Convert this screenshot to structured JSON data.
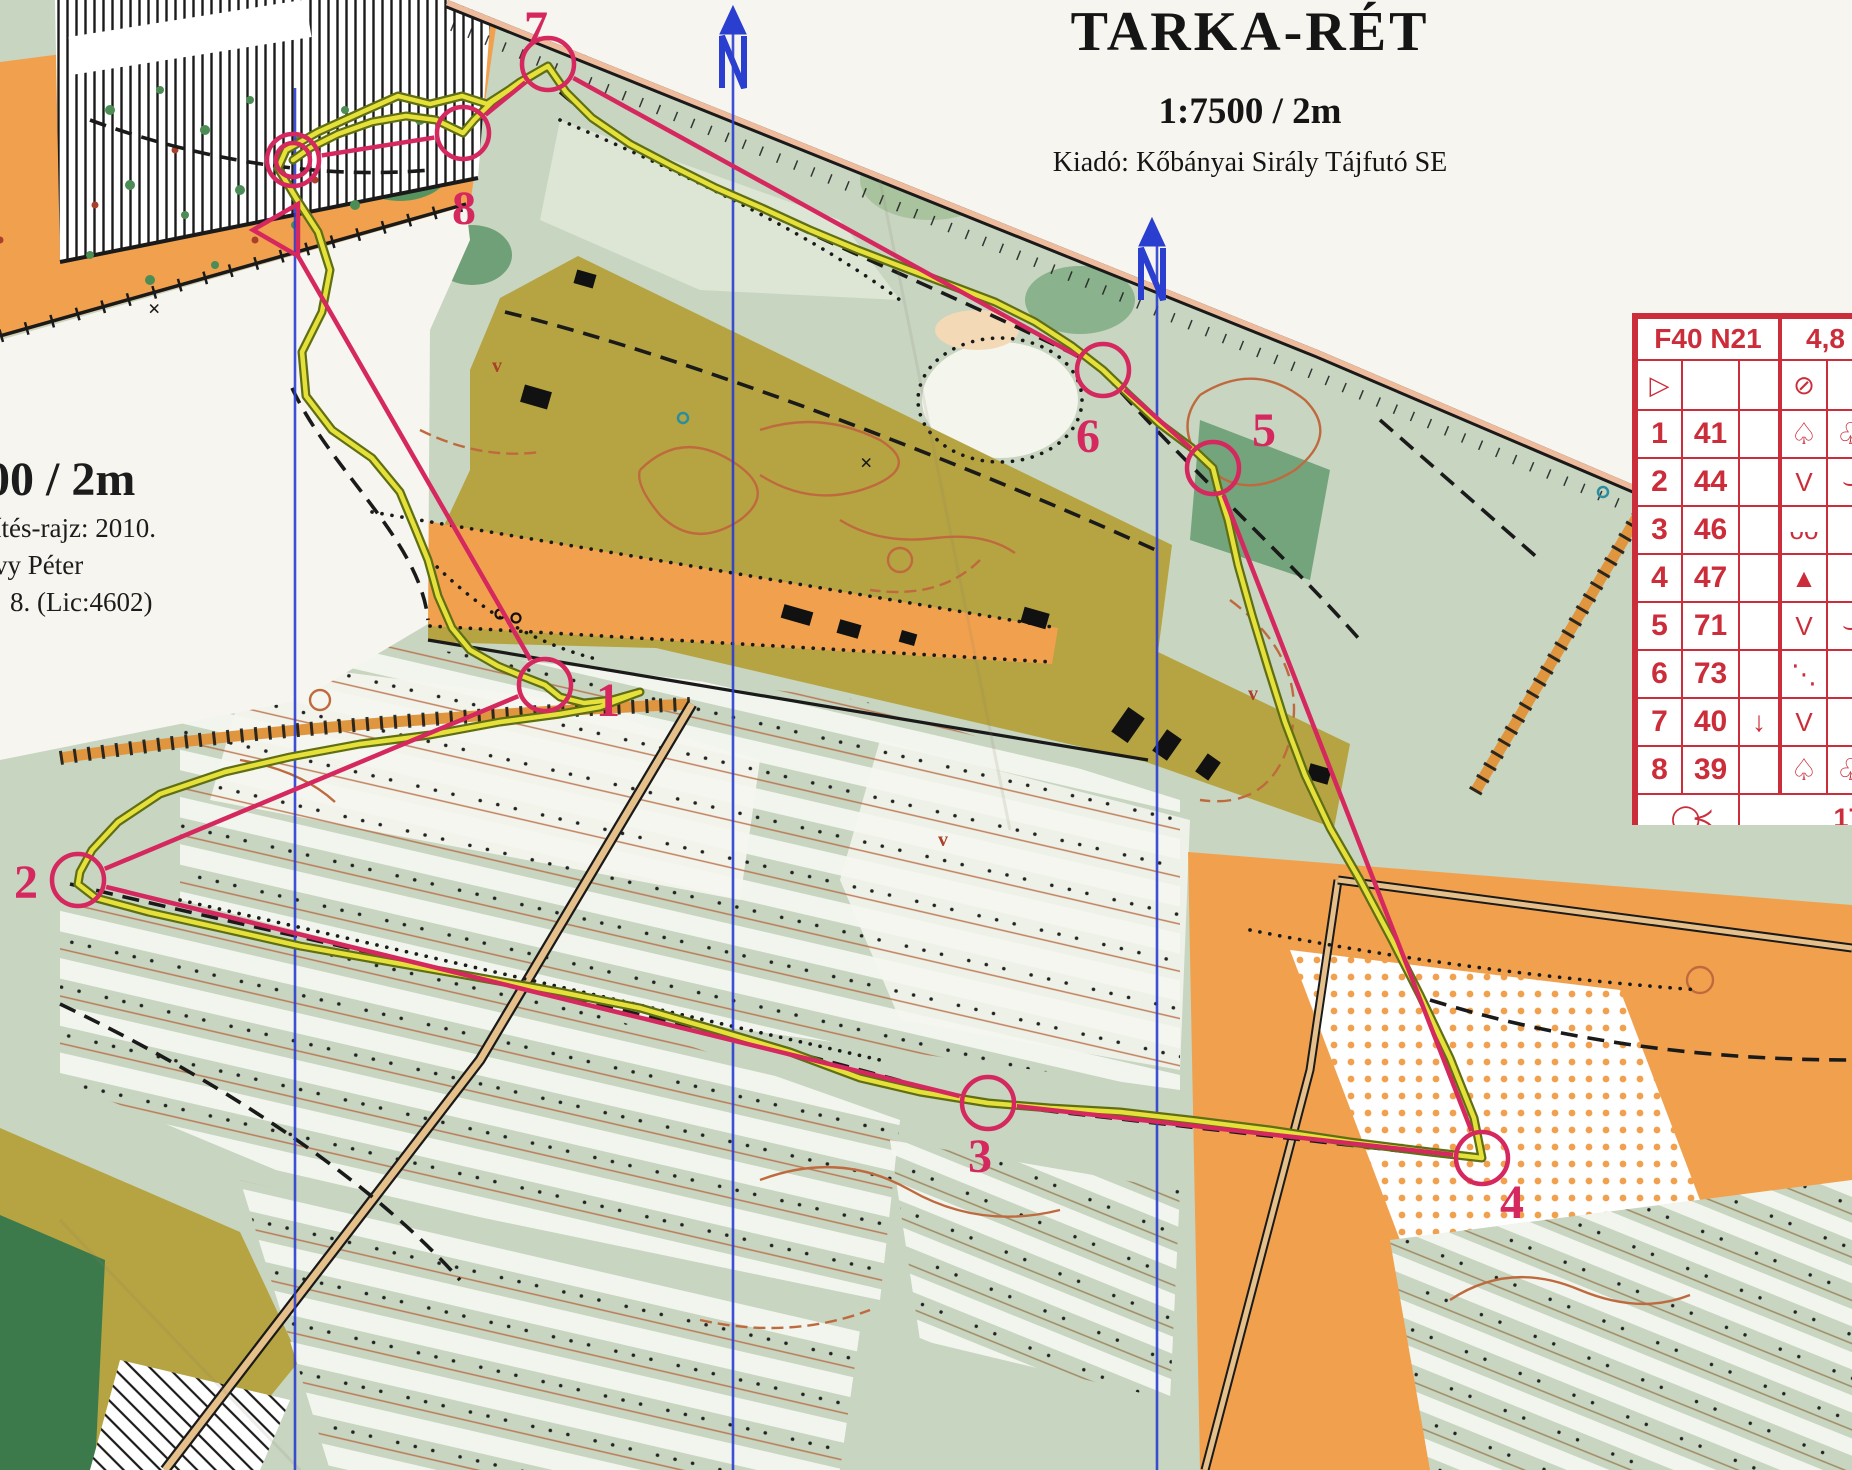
{
  "title_block": {
    "title": "TARKA-RÉT",
    "scale": "1:7500 / 2m",
    "publisher": "Kiadó: Kőbányai Sirály Tájfutó SE"
  },
  "margin_notes": {
    "scale_fragment": "00 / 2m",
    "line1": "ítés-rajz: 2010.",
    "line2": "vy Péter",
    "line3": "8. (Lic:4602)"
  },
  "control_card": {
    "class_label": "F40 N21",
    "course_length": "4,8",
    "finish_distance": "170 m",
    "start_symbol": "▷",
    "start_feature_symbol": "⊘",
    "finish_symbol": "◯≺",
    "rows": [
      {
        "num": "1",
        "code": "41",
        "c": "",
        "d": "♤",
        "e": "♧"
      },
      {
        "num": "2",
        "code": "44",
        "c": "",
        "d": "V",
        "e": "⌣"
      },
      {
        "num": "3",
        "code": "46",
        "c": "",
        "d": "ᴗᴗ",
        "e": ""
      },
      {
        "num": "4",
        "code": "47",
        "c": "",
        "d": "▲",
        "e": ""
      },
      {
        "num": "5",
        "code": "71",
        "c": "",
        "d": "V",
        "e": "⌣"
      },
      {
        "num": "6",
        "code": "73",
        "c": "",
        "d": "⋱",
        "e": ""
      },
      {
        "num": "7",
        "code": "40",
        "c": "↓",
        "d": "V",
        "e": ""
      },
      {
        "num": "8",
        "code": "39",
        "c": "",
        "d": "♤",
        "e": "♧"
      }
    ]
  },
  "course": {
    "color": "#d4285f",
    "controls": [
      {
        "id": "S",
        "x": 283,
        "y": 230
      },
      {
        "id": "1",
        "x": 545,
        "y": 685,
        "lx": 596,
        "ly": 716
      },
      {
        "id": "2",
        "x": 78,
        "y": 880,
        "lx": 14,
        "ly": 898
      },
      {
        "id": "3",
        "x": 988,
        "y": 1103,
        "lx": 968,
        "ly": 1172
      },
      {
        "id": "4",
        "x": 1482,
        "y": 1158,
        "lx": 1500,
        "ly": 1218
      },
      {
        "id": "5",
        "x": 1213,
        "y": 468,
        "lx": 1252,
        "ly": 446
      },
      {
        "id": "6",
        "x": 1103,
        "y": 370,
        "lx": 1076,
        "ly": 452
      },
      {
        "id": "7",
        "x": 548,
        "y": 64,
        "lx": 524,
        "ly": 44
      },
      {
        "id": "8",
        "x": 463,
        "y": 133,
        "lx": 452,
        "ly": 224
      },
      {
        "id": "F",
        "x": 293,
        "y": 160
      }
    ]
  },
  "gps_track": {
    "color_core": "#e6e13a",
    "color_edge": "#606e14",
    "points": [
      [
        548,
        66
      ],
      [
        518,
        84
      ],
      [
        487,
        104
      ],
      [
        462,
        96
      ],
      [
        430,
        104
      ],
      [
        398,
        96
      ],
      [
        362,
        112
      ],
      [
        318,
        132
      ],
      [
        286,
        150
      ],
      [
        278,
        168
      ],
      [
        296,
        198
      ],
      [
        318,
        232
      ],
      [
        330,
        270
      ],
      [
        322,
        312
      ],
      [
        302,
        352
      ],
      [
        306,
        396
      ],
      [
        332,
        430
      ],
      [
        372,
        458
      ],
      [
        400,
        492
      ],
      [
        415,
        528
      ],
      [
        428,
        560
      ],
      [
        438,
        596
      ],
      [
        452,
        628
      ],
      [
        470,
        650
      ],
      [
        498,
        666
      ],
      [
        522,
        676
      ],
      [
        545,
        685
      ],
      [
        560,
        697
      ],
      [
        584,
        703
      ],
      [
        612,
        700
      ],
      [
        640,
        692
      ],
      [
        600,
        707
      ],
      [
        560,
        714
      ],
      [
        500,
        722
      ],
      [
        430,
        735
      ],
      [
        360,
        744
      ],
      [
        290,
        757
      ],
      [
        225,
        772
      ],
      [
        160,
        794
      ],
      [
        118,
        822
      ],
      [
        92,
        850
      ],
      [
        80,
        872
      ],
      [
        78,
        884
      ],
      [
        96,
        898
      ],
      [
        148,
        912
      ],
      [
        220,
        928
      ],
      [
        300,
        946
      ],
      [
        390,
        962
      ],
      [
        470,
        976
      ],
      [
        560,
        992
      ],
      [
        640,
        1008
      ],
      [
        716,
        1030
      ],
      [
        790,
        1052
      ],
      [
        860,
        1078
      ],
      [
        920,
        1092
      ],
      [
        988,
        1103
      ],
      [
        1050,
        1108
      ],
      [
        1120,
        1112
      ],
      [
        1190,
        1120
      ],
      [
        1270,
        1130
      ],
      [
        1350,
        1142
      ],
      [
        1430,
        1152
      ],
      [
        1482,
        1158
      ],
      [
        1474,
        1118
      ],
      [
        1450,
        1058
      ],
      [
        1420,
        995
      ],
      [
        1392,
        940
      ],
      [
        1360,
        880
      ],
      [
        1330,
        828
      ],
      [
        1305,
        775
      ],
      [
        1285,
        722
      ],
      [
        1268,
        668
      ],
      [
        1252,
        615
      ],
      [
        1238,
        565
      ],
      [
        1228,
        520
      ],
      [
        1218,
        488
      ],
      [
        1213,
        468
      ],
      [
        1192,
        448
      ],
      [
        1160,
        424
      ],
      [
        1130,
        396
      ],
      [
        1103,
        370
      ],
      [
        1072,
        346
      ],
      [
        1035,
        322
      ],
      [
        995,
        302
      ],
      [
        950,
        285
      ],
      [
        905,
        268
      ],
      [
        858,
        250
      ],
      [
        810,
        230
      ],
      [
        762,
        208
      ],
      [
        716,
        188
      ],
      [
        672,
        166
      ],
      [
        630,
        144
      ],
      [
        592,
        118
      ],
      [
        566,
        92
      ],
      [
        548,
        66
      ],
      [
        520,
        82
      ],
      [
        492,
        102
      ],
      [
        474,
        120
      ],
      [
        463,
        133
      ],
      [
        436,
        120
      ],
      [
        406,
        116
      ],
      [
        372,
        122
      ],
      [
        338,
        134
      ],
      [
        310,
        148
      ],
      [
        293,
        160
      ]
    ]
  },
  "north": {
    "line_color": "#2a3ed0",
    "lines": [
      {
        "x": 295,
        "y1": 88
      },
      {
        "x": 733,
        "y1": 18
      },
      {
        "x": 1157,
        "y1": 243
      }
    ]
  }
}
